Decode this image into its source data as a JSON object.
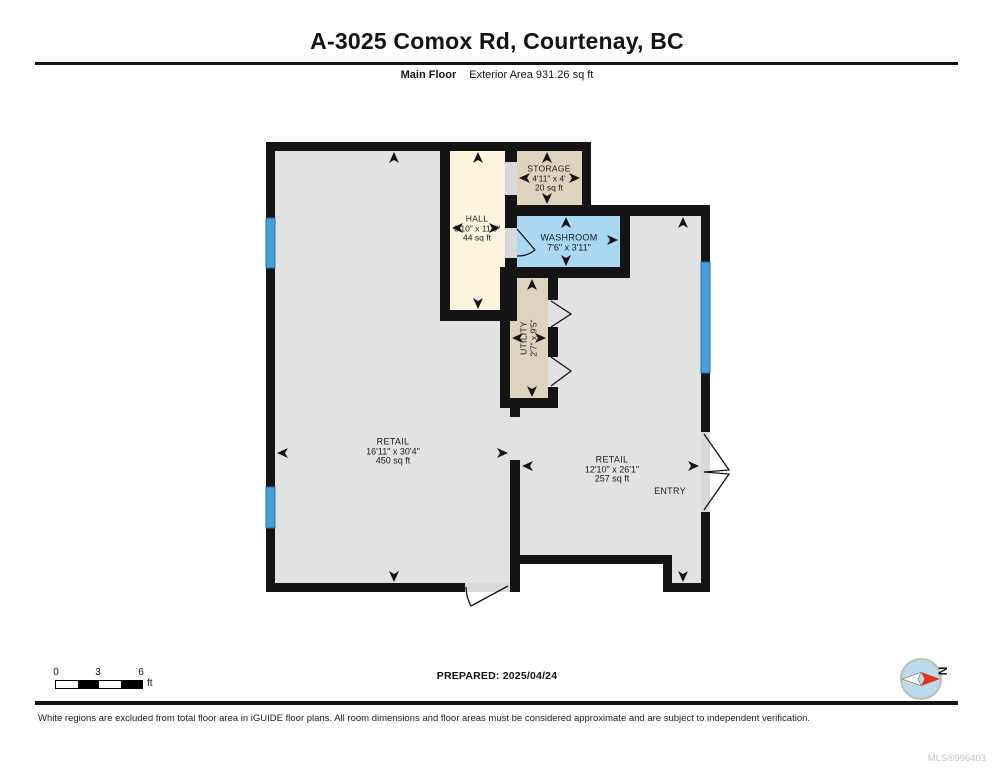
{
  "header": {
    "title": "A-3025 Comox Rd, Courtenay, BC",
    "floor_label": "Main Floor",
    "area_label": "Exterior Area 931.26 sq ft"
  },
  "rooms": {
    "retail_left": {
      "name": "RETAIL",
      "dims": "16'11\" x 30'4\"",
      "area": "450 sq ft"
    },
    "retail_right": {
      "name": "RETAIL",
      "dims": "12'10\" x 26'1\"",
      "area": "257 sq ft"
    },
    "hall": {
      "name": "HALL",
      "dims": "3'10\" x 11'6\"",
      "area": "44 sq ft"
    },
    "storage": {
      "name": "STORAGE",
      "dims": "4'11\" x 4'",
      "area": "20 sq ft"
    },
    "washroom": {
      "name": "WASHROOM",
      "dims": "7'6\" x 3'11\""
    },
    "utility": {
      "name": "UTILITY",
      "dims": "2'7\" x 9'5\""
    },
    "entry": {
      "name": "ENTRY"
    }
  },
  "scale_bar": {
    "tick0": "0",
    "tick1": "3",
    "tick2": "6",
    "unit": "ft"
  },
  "footer": {
    "prepared": "PREPARED: 2025/04/24",
    "disclaimer": "White regions are excluded from total floor area in iGUIDE floor plans. All room dimensions and floor areas must be considered approximate and are subject to independent verification.",
    "mls": "MLS®996403"
  },
  "compass": {
    "north_label": "N",
    "needle_red": "#e8321c",
    "needle_white": "#ffffff",
    "disc_blue": "#b9dcec",
    "ring": "#c6bcaa"
  },
  "colors": {
    "wall": "#141414",
    "floor": "#e2e2e2",
    "hall": "#fcf4dd",
    "storage": "#ded3bf",
    "washroom": "#a9d8f2",
    "window": "#45a0d6",
    "opening": "#d9d9d9"
  }
}
